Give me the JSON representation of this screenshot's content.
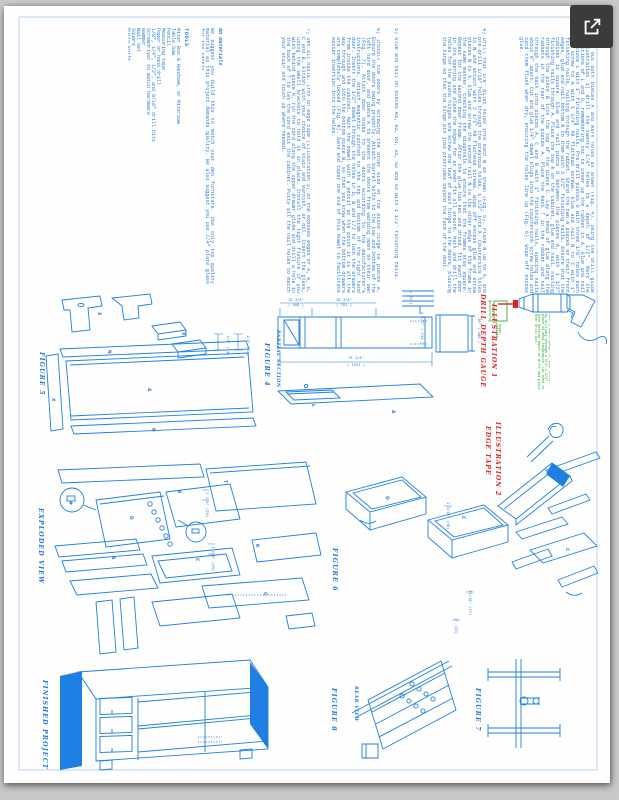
{
  "viewer": {
    "background": "#c9c9c9",
    "expand_button": {
      "icon": "open-in-new-icon",
      "label": "Open in new window"
    }
  },
  "sheet": {
    "accent_blue": "#1f7fe3",
    "text_blue": "#2d7bdb",
    "red": "#e02020",
    "green": "#18a818",
    "paragraphs": [
      "3)  Lay out both pieces A and mark holes as shown (Fig. 4). Using the drill guide (Illustration 1) drill the twenty 1/4\" holes to a depth of 1/2\". Mark the positions of L and O, remembering not to cover up the rabbet in A. Glue and nail on piece L with 1\" finishing nails. Pre-drill pieces O with three 1/8\" holes each and screw to A with 1 1/4\" #8 flathead screws. Glue and nail N to C with 1\" finishing nails, nailing through the rabbet. Stand the two A pieces on their front edges, glue and nail bottom B to them with 1 1/2\" finishing nails. Ensure that the cabinet is square. Glue and nail piece D between the pieces A, with 1 1/2\" finishing nails through A. Place the top K on the cabinet, glue and nail, nailing through the piece B into the top of the piece C. Lay a bead of glue along the rabbets in the rear of the pieces A. Place the back T in the rabbet and nail through the back into pieces A, C and B with 1\" finishing nails, spacing nails about 6\" apart. Cut and glue 1/4\" dowel plugs into the countersunk screw holes and sand them flush when dry, ensuring the holes line up (Fig. 6). Wipe off excess glue.",
      "4)  Drill four 1/8\" pilot holes into each N as shown (Fig. 5). Place N up to X, and pre-drill 1/16\" holes through the previous holes, 1 1/2\" into X. Countersink holes in N and attach with 2 1/2\" #8 flathead screws. Wipe off excess glue and screw pieces N to X. Glue and screw the second rail N to the other edge of the frame in the same manner, checking the diagonals to ensure that the frames stay square. Repeat for the second door frame. After the glue has set and dried, fit each door in its opening and plane the edges for an even fit all around. Mark and drill the holes for the piano hinges and screw one leaf of each hinge to the doors, placing the hinge so that the hinge pin just protrudes beyond the face of the door.",
      "5)  Glue and nail on pieces R1, R2, R3, S1, S2 and S3 with 1 1/2\" finishing nails.",
      "6)  Install the doors by screwing the other side of the piano hinge to pieces A. Ensure the doors swing properly. Attach barrel bolts to the top and bottom of the left hand door, and piece K to prevent the doors from warping open on their own (Fig. 7). Attach door knobs to the doors according to the manufacturer's instructions. Attach magnetic catches to the top and bottom of the right hand door. Insert the 1/2\" dowel through the holes in D, B and L/J to lock the drawers from inside the cabinet. Mark the dowel with a pencil at the point it is all the way through and into the bottom piece B, so that you know when the bottom drawers are completely locked (Fig. 8). Sand and taper one end of this dowel to facilitate easier insertion into the holes.",
      "7)  Set all nails. Iron on edge tape (Illustration 2) on the exposed edges of A, K, D, C and B. Finish with your choice of stain and varnish, or oil. Insert the glass, using the small brackets to hold it in place. Install the light fixture if you wish behind piece K, run the cord along the upper drawer glide and drill a hole in the back of T to let the cord exit the cabinet. Putty all the nail holes to match your stain and touch up where needed."
    ],
    "materials": {
      "heading": "On materials",
      "text": "We suggest you build this to match your den furniture. Use only top quality material as this project demands quality. We also suggest you use 1/4\" plate glass for the panels."
    },
    "tools": {
      "heading": "TOOLS",
      "items": [
        "Miter Box & Handsaw, or Mitersaw",
        "Table Saw",
        "Pencil",
        "Measuring tape",
        "Power or hand drill",
        "1/8\", 1/4\", 1/2\", and 9/16\" drill bits",
        "Screwdriver to match hardware",
        "Hammer",
        "Nail Set",
        "Square",
        "Putty knife",
        "Four C clamps"
      ]
    },
    "labels": {
      "figure4": "FIGURE 4",
      "partial_section": "PARTIAL SECTION",
      "figure5": "FIGURE 5",
      "exploded_view": "EXPLODED VIEW",
      "figure6": "FIGURE 6",
      "finished_project": "FINISHED PROJECT",
      "figure8": "FIGURE 8",
      "rear_view": "REAR VIEW",
      "figure7": "FIGURE 7"
    },
    "illustration1": {
      "title": "DRILL DEPTH GAUGE",
      "number": "ILLUSTRATION 1",
      "note": "Make a depth gauge for your drill - by drilling through a 3/4\" x 3/4\" piece of wood lengthwise. Cut wood to give desired depth of drill and place over drill bit.",
      "depth_label": "depth desired"
    },
    "illustration2": {
      "title": "EDGE TAPE",
      "number": "ILLUSTRATION 2"
    },
    "dims": {
      "fig4": [
        "15 3/4\"",
        "( 400 )",
        "30 3/4\"",
        "( 781 )",
        "75 1/4\"",
        "( 1911 )",
        "16\" ( 406 )",
        "4 1/2\" ( 114 )",
        "( 61 )"
      ],
      "fig5": [
        "1/2\" (13)",
        "1/2\" (13)"
      ],
      "fig6": [
        "1 3/16\" (30)",
        "11/16\" (17)",
        "1\" (25)"
      ],
      "exploded": [
        "1 1/8\" (29)",
        "1 1/8\" (29)"
      ]
    },
    "letters": {
      "A": "A",
      "B": "B",
      "C": "C",
      "D": "D",
      "K": "K",
      "L": "L",
      "N": "N",
      "Q": "Q",
      "T": "T",
      "X": "X"
    }
  }
}
